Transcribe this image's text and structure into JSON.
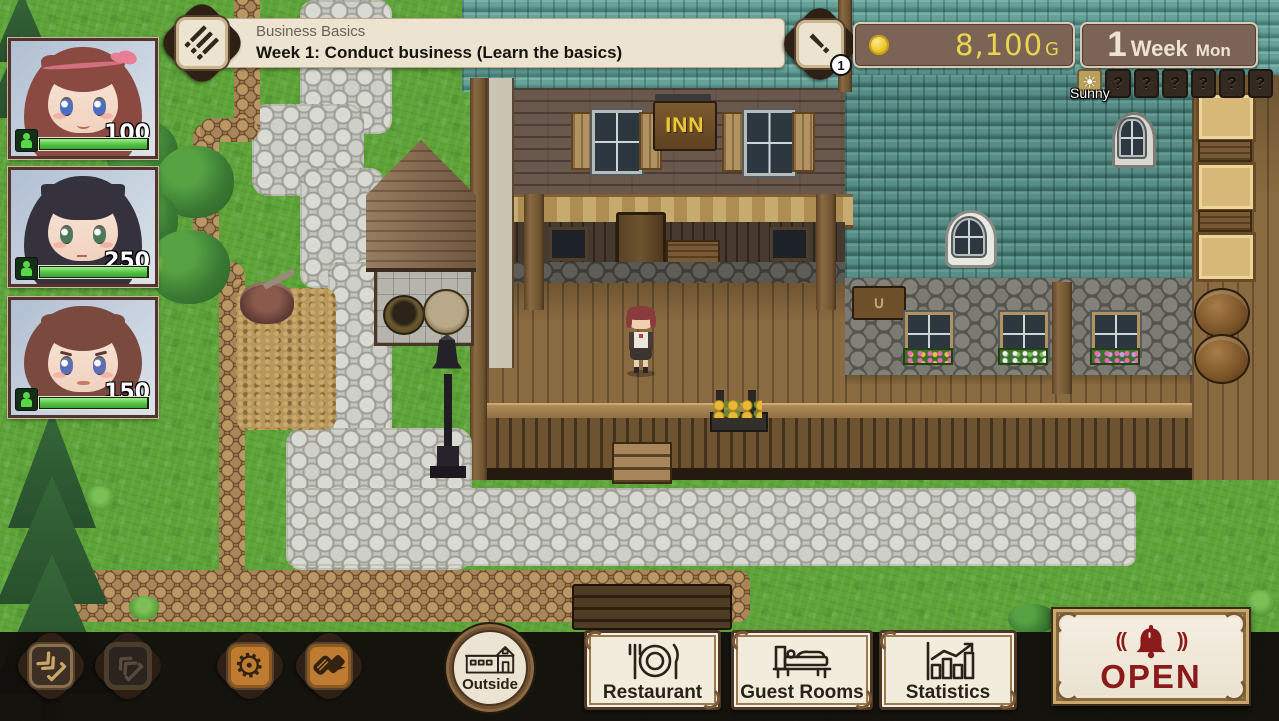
{
  "quest_banner": {
    "title": "Business Basics",
    "objective": "Week 1: Conduct business (Learn the basics)"
  },
  "alert_badge": {
    "glyph": "!",
    "count": "1"
  },
  "hud": {
    "money": "8,100",
    "currency": "G",
    "week_number": "1",
    "week_label": "Week",
    "day_label": "Mon"
  },
  "weather": {
    "today": "Sunny",
    "sun_glyph": "☀",
    "forecast": [
      "?",
      "?",
      "?",
      "?",
      "?",
      "?"
    ]
  },
  "party": [
    {
      "id": "heroine-1",
      "hp": "100",
      "hair_color": "#8a4a42",
      "eye_color": "#4a6fc0"
    },
    {
      "id": "heroine-2",
      "hp": "250",
      "hair_color": "#35323e",
      "eye_color": "#4a7a5a"
    },
    {
      "id": "heroine-3",
      "hp": "150",
      "hair_color": "#7a4a3e",
      "eye_color": "#5a6fb8"
    }
  ],
  "map": {
    "inn_sign": "INN"
  },
  "toolbar": {
    "icons": {
      "save": "save",
      "load": "load",
      "settings": "⚙",
      "chat": "chat"
    },
    "outside_label": "Outside",
    "tabs": [
      {
        "label": "Restaurant"
      },
      {
        "label": "Guest Rooms"
      },
      {
        "label": "Statistics"
      }
    ],
    "open_label": "OPEN"
  },
  "colors": {
    "money_text": "#e9d64d",
    "panel_brown": "#7b6355",
    "open_red": "#8b1a1a",
    "hp_green": "#52c244",
    "accent_orange": "#c07b33"
  }
}
